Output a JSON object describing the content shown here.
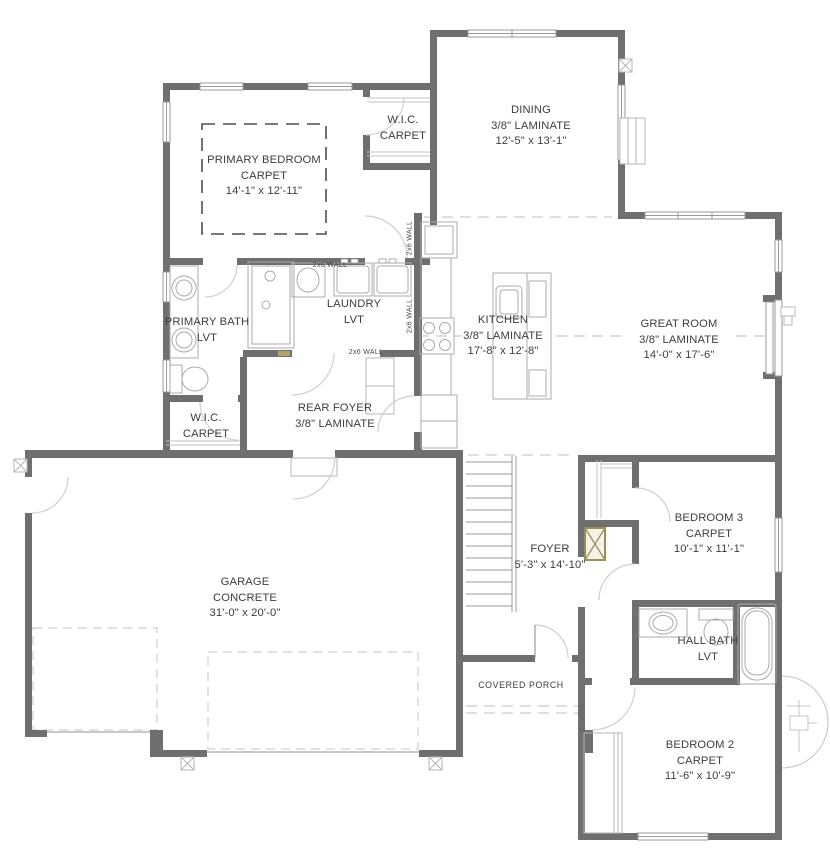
{
  "rooms": [
    {
      "name": "PRIMARY BEDROOM",
      "floor": "CARPET",
      "dims": "14'-1\" x 12'-11\""
    },
    {
      "name": "W.I.C.",
      "floor": "CARPET",
      "dims": ""
    },
    {
      "name": "DINING",
      "floor": "3/8\" LAMINATE",
      "dims": "12'-5\" x 13'-1\""
    },
    {
      "name": "LAUNDRY",
      "floor": "LVT",
      "dims": ""
    },
    {
      "name": "PRIMARY BATH",
      "floor": "LVT",
      "dims": ""
    },
    {
      "name": "KITCHEN",
      "floor": "3/8\" LAMINATE",
      "dims": "17'-8\" x 12'-8\""
    },
    {
      "name": "GREAT ROOM",
      "floor": "3/8\" LAMINATE",
      "dims": "14'-0\" x 17'-6\""
    },
    {
      "name": "W.I.C.",
      "floor": "CARPET",
      "dims": ""
    },
    {
      "name": "REAR FOYER",
      "floor": "3/8\" LAMINATE",
      "dims": ""
    },
    {
      "name": "GARAGE",
      "floor": "CONCRETE",
      "dims": "31'-0\" x 20'-0\""
    },
    {
      "name": "FOYER",
      "floor": "",
      "dims": "5'-3\" x 14'-10\""
    },
    {
      "name": "BEDROOM 3",
      "floor": "CARPET",
      "dims": "10'-1\" x 11'-1\""
    },
    {
      "name": "HALL BATH",
      "floor": "LVT",
      "dims": ""
    },
    {
      "name": "BEDROOM 2",
      "floor": "CARPET",
      "dims": "11'-6\" x 10'-9\""
    },
    {
      "name": "COVERED PORCH",
      "floor": "",
      "dims": ""
    }
  ],
  "annotations": {
    "wall_2x6": "2x6 WALL"
  },
  "colors": {
    "wall": "#6f6f6f",
    "fixture_line": "#ababab",
    "dashed_line": "#c9c9c9",
    "text": "#3d3d3d",
    "accent_tan": "#9b8d58"
  }
}
